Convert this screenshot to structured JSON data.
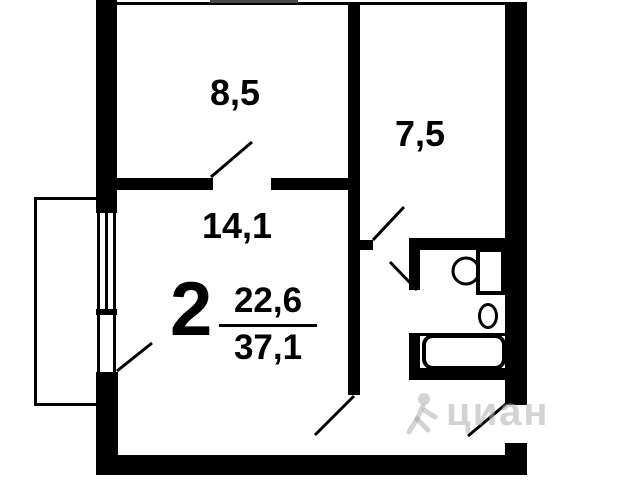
{
  "plan": {
    "rooms": [
      {
        "id": "room-top-left",
        "area": "8,5"
      },
      {
        "id": "room-top-right",
        "area": "7,5"
      },
      {
        "id": "room-living",
        "area": "14,1"
      }
    ],
    "summary": {
      "room_count": "2",
      "living_area": "22,6",
      "total_area": "37,1"
    },
    "watermark": {
      "text": "циан"
    },
    "icons": [
      "toilet-icon",
      "sink-icon",
      "bathtub-icon",
      "cian-person-icon"
    ],
    "colors": {
      "wall": "#000000",
      "background": "#ffffff",
      "watermark": "#bebebe",
      "top_edge_bar": "#4a4a4a"
    }
  }
}
